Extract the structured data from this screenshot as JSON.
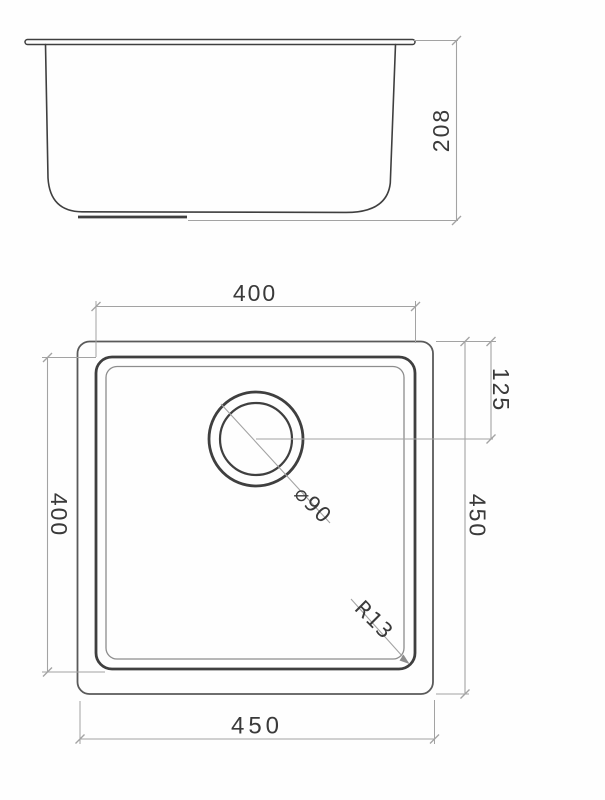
{
  "drawing_type": "sink-technical-drawing",
  "colors": {
    "background": "#fefefe",
    "object_line_heavy": "#3f3f3f",
    "object_line": "#5a5a5a",
    "object_line_light": "#8d8d8d",
    "dimension_line": "#a3a3a3",
    "text": "#3a3a3a"
  },
  "side_view": {
    "depth_label": "208"
  },
  "plan_view": {
    "inner_width_label": "400",
    "inner_depth_label": "400",
    "drain_offset_label": "125",
    "outer_height_label": "450",
    "outer_width_label": "450",
    "drain_diameter_label": "⌀90",
    "corner_radius_label": "R13"
  }
}
